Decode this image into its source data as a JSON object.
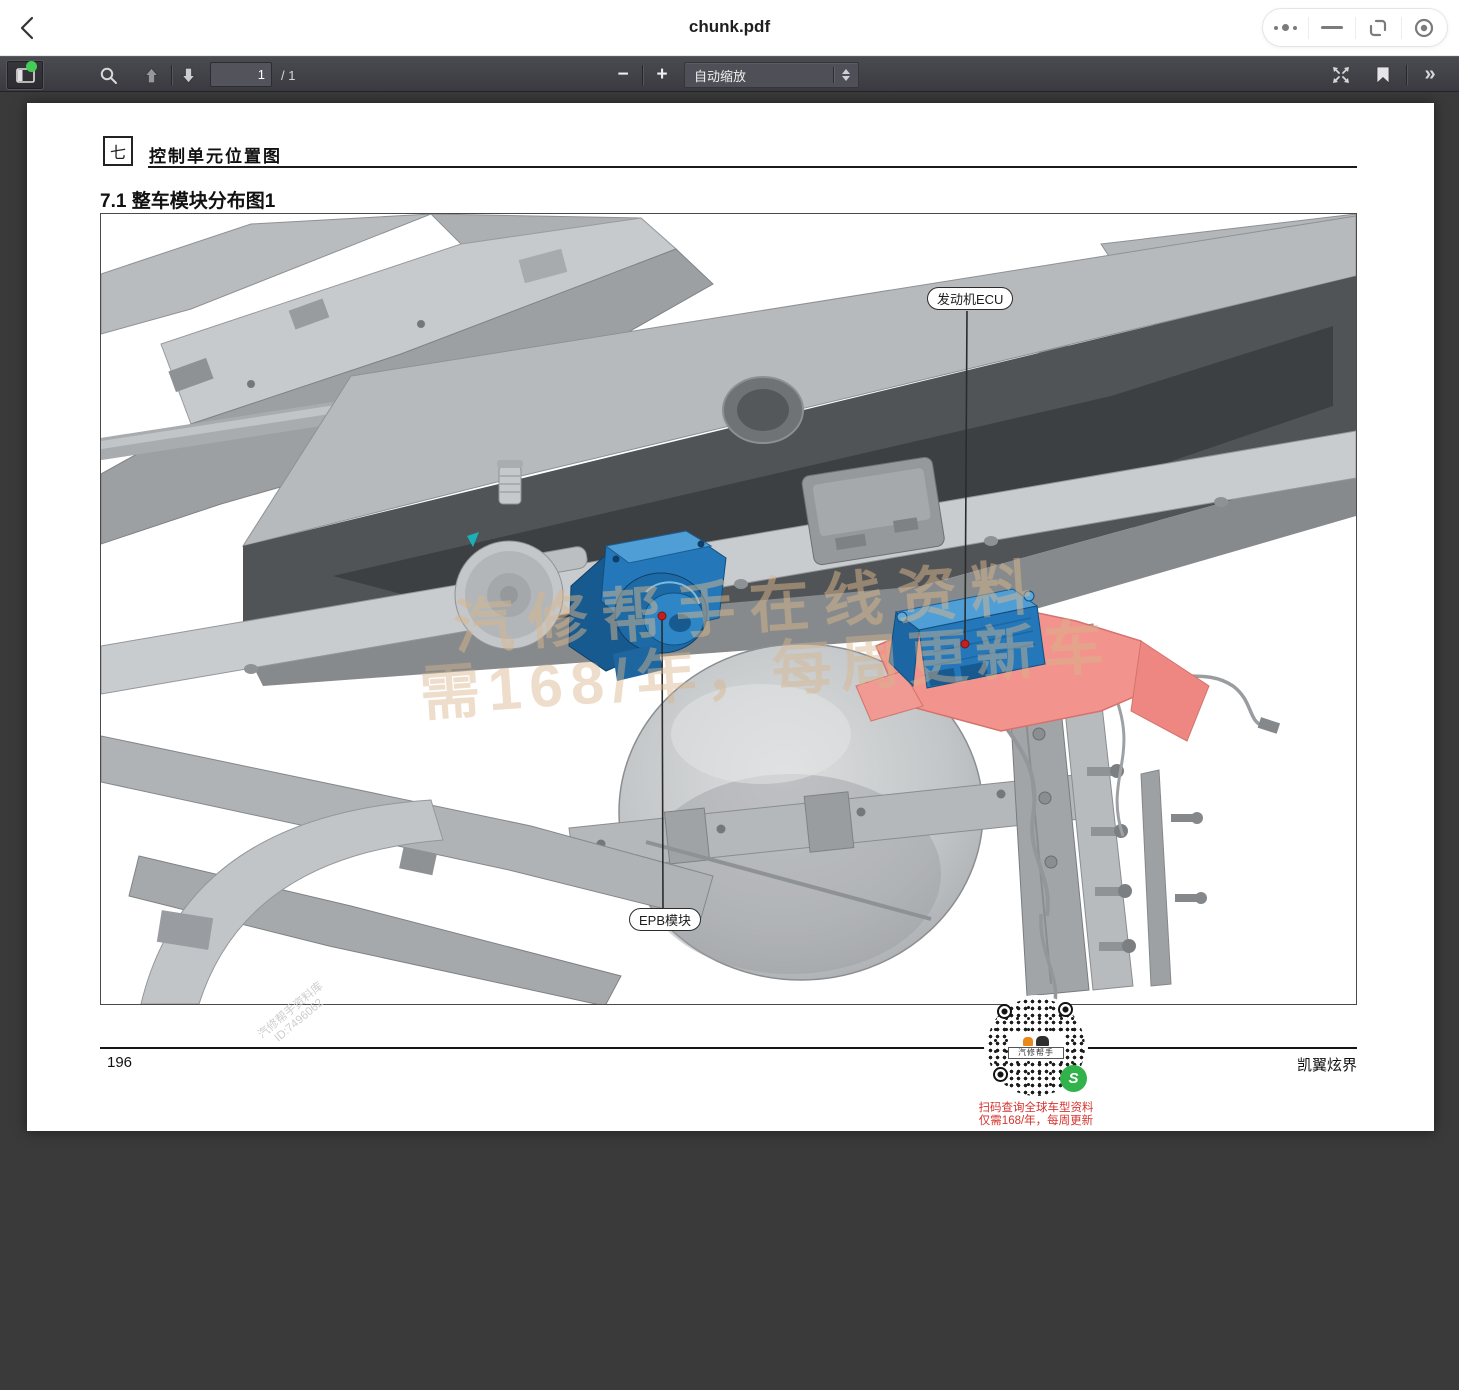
{
  "app_bar": {
    "title": "chunk.pdf"
  },
  "toolbar": {
    "page_current": "1",
    "page_total_label": "/ 1",
    "zoom_out_label": "−",
    "zoom_in_label": "+",
    "zoom_mode": "自动缩放",
    "more_tools_label": "»"
  },
  "page": {
    "chapter_badge": "七",
    "chapter_title": "控制单元位置图",
    "section_title": "7.1 整车模块分布图1",
    "callouts": [
      {
        "label": "发动机ECU"
      },
      {
        "label": "EPB模块"
      }
    ],
    "watermark": {
      "figure_line1": "汽修帮手在线资料",
      "figure_line2": "需168/年，每周更新车",
      "footer_line1": "汽修帮手资料库",
      "footer_line2": "ID:7496062"
    },
    "footer": {
      "page_number": "196",
      "doc_title": "凯翼炫界"
    },
    "qr": {
      "logo_text": "汽修帮手",
      "wechat_glyph": "S",
      "promo_line1": "扫码查询全球车型资料",
      "promo_line2": "仅需168/年，每周更新"
    },
    "colors": {
      "module_blue": "#2478ba",
      "bracket_pink": "#f2948d",
      "marker_red": "#bf2020",
      "watermark_tan": "#d8b68c"
    }
  }
}
